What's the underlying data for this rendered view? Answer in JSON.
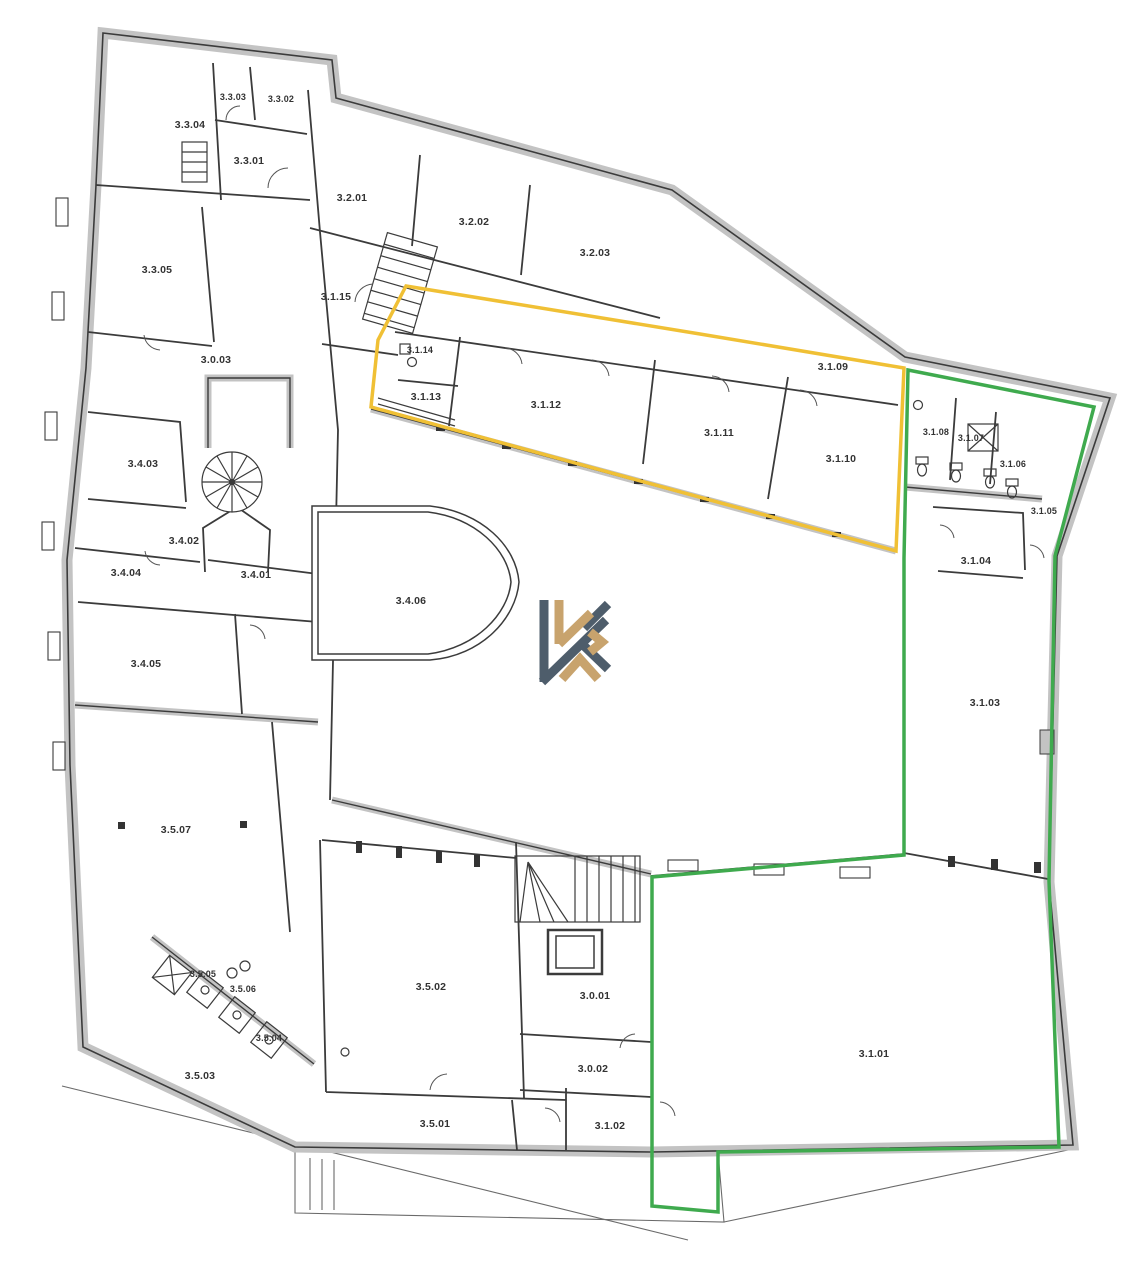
{
  "plan": {
    "rooms": [
      {
        "id": "3.3.04",
        "x": 190,
        "y": 125
      },
      {
        "id": "3.3.03",
        "x": 233,
        "y": 97
      },
      {
        "id": "3.3.02",
        "x": 281,
        "y": 99
      },
      {
        "id": "3.3.01",
        "x": 249,
        "y": 161
      },
      {
        "id": "3.2.01",
        "x": 352,
        "y": 198
      },
      {
        "id": "3.2.02",
        "x": 474,
        "y": 222
      },
      {
        "id": "3.2.03",
        "x": 595,
        "y": 253
      },
      {
        "id": "3.3.05",
        "x": 157,
        "y": 270
      },
      {
        "id": "3.1.15",
        "x": 336,
        "y": 297
      },
      {
        "id": "3.0.03",
        "x": 216,
        "y": 360
      },
      {
        "id": "3.1.14",
        "x": 420,
        "y": 350
      },
      {
        "id": "3.1.13",
        "x": 426,
        "y": 397
      },
      {
        "id": "3.1.12",
        "x": 546,
        "y": 405
      },
      {
        "id": "3.1.09",
        "x": 833,
        "y": 367
      },
      {
        "id": "3.1.11",
        "x": 719,
        "y": 433
      },
      {
        "id": "3.1.10",
        "x": 841,
        "y": 459
      },
      {
        "id": "3.1.08",
        "x": 936,
        "y": 432
      },
      {
        "id": "3.1.07",
        "x": 971,
        "y": 438
      },
      {
        "id": "3.1.06",
        "x": 1013,
        "y": 464
      },
      {
        "id": "3.1.05",
        "x": 1044,
        "y": 511
      },
      {
        "id": "3.4.03",
        "x": 143,
        "y": 464
      },
      {
        "id": "3.4.02",
        "x": 184,
        "y": 541
      },
      {
        "id": "3.4.04",
        "x": 126,
        "y": 573
      },
      {
        "id": "3.4.01",
        "x": 256,
        "y": 575
      },
      {
        "id": "3.1.04",
        "x": 976,
        "y": 561
      },
      {
        "id": "3.4.06",
        "x": 411,
        "y": 601
      },
      {
        "id": "3.4.05",
        "x": 146,
        "y": 664
      },
      {
        "id": "3.1.03",
        "x": 985,
        "y": 703
      },
      {
        "id": "3.5.07",
        "x": 176,
        "y": 830
      },
      {
        "id": "3.5.05",
        "x": 203,
        "y": 974
      },
      {
        "id": "3.5.06",
        "x": 243,
        "y": 989
      },
      {
        "id": "3.5.04",
        "x": 269,
        "y": 1038
      },
      {
        "id": "3.5.03",
        "x": 200,
        "y": 1076
      },
      {
        "id": "3.5.02",
        "x": 431,
        "y": 987
      },
      {
        "id": "3.0.01",
        "x": 595,
        "y": 996
      },
      {
        "id": "3.0.02",
        "x": 593,
        "y": 1069
      },
      {
        "id": "3.5.01",
        "x": 435,
        "y": 1124
      },
      {
        "id": "3.1.02",
        "x": 610,
        "y": 1126
      },
      {
        "id": "3.1.01",
        "x": 874,
        "y": 1054
      }
    ],
    "overlays": {
      "unit_yellow": {
        "color": "#f0c035"
      },
      "unit_green": {
        "color": "#3faa4e"
      }
    },
    "palette": {
      "wall_fill": "#c3c3c3",
      "wall_line": "#3b3b3b",
      "label_color": "#333333",
      "background": "#ffffff"
    },
    "logo": {
      "dark": "#4e5d6b",
      "gold": "#c8a36d"
    }
  }
}
